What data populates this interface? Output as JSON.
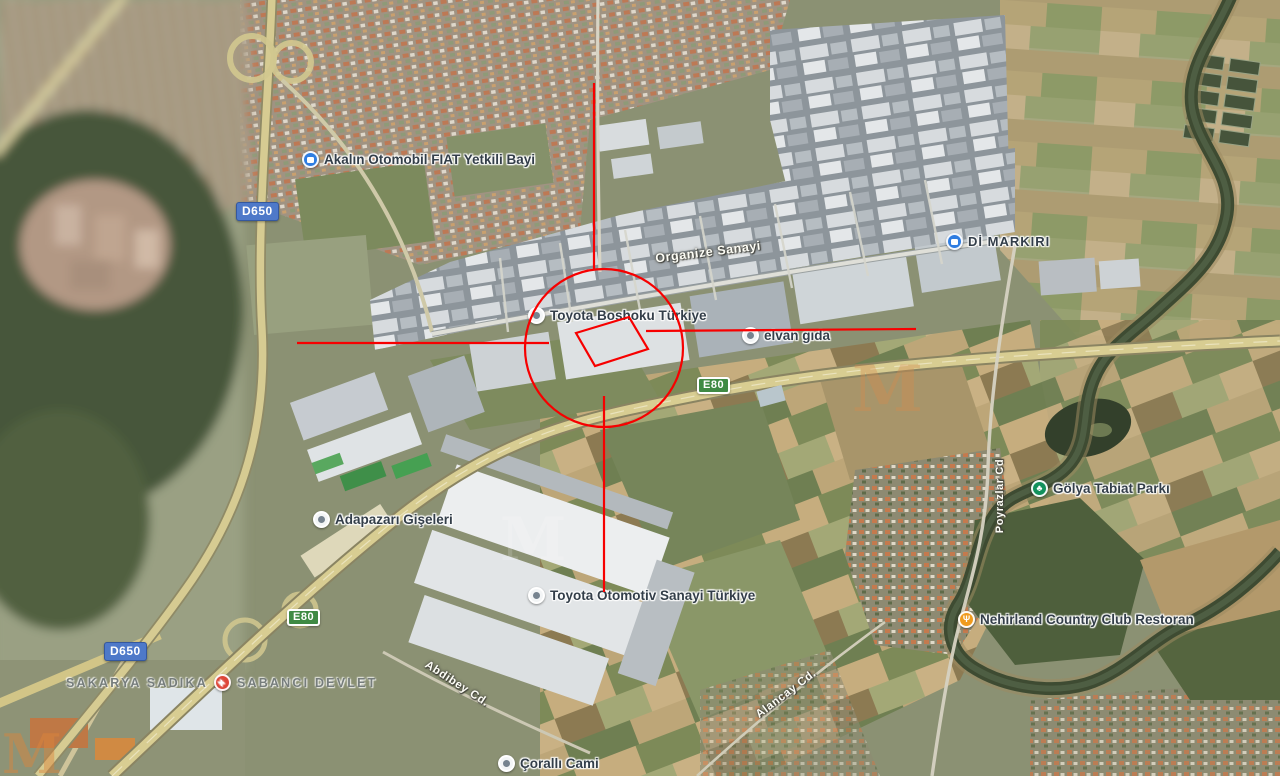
{
  "map": {
    "pois": [
      {
        "id": "fiat-dealer",
        "label": "Akalın Otomobil FIAT Yetkili Bayi",
        "icon": "car-dealer-icon",
        "icon_color": "#2f7de1"
      },
      {
        "id": "market",
        "label": "Dİ MARKIRI",
        "icon": "store-icon",
        "icon_color": "#2f7de1"
      },
      {
        "id": "toyota-boshoku",
        "label": "Toyota Boshoku Türkiye",
        "icon": "factory-poi-icon",
        "icon_color": "#f3f5f6"
      },
      {
        "id": "elvan-gida",
        "label": "elvan gıda",
        "icon": "store-poi-icon",
        "icon_color": "#f3f5f6"
      },
      {
        "id": "golya-park",
        "label": "Gölya Tabiat Parkı",
        "icon": "park-tree-icon",
        "icon_color": "#12915c"
      },
      {
        "id": "adapazari-giseleri",
        "label": "Adapazarı Gişeleri",
        "icon": "toll-poi-icon",
        "icon_color": "#f3f5f6"
      },
      {
        "id": "toyota-otomotiv",
        "label": "Toyota Otomotiv Sanayi Türkiye",
        "icon": "factory-poi-icon",
        "icon_color": "#f3f5f6"
      },
      {
        "id": "nehirland",
        "label": "Nehirland Country Club Restoran",
        "icon": "restaurant-icon",
        "icon_color": "#f09b1d"
      },
      {
        "id": "coralli-cami",
        "label": "Çorallı Cami",
        "icon": "poi-pin-icon",
        "icon_color": "#f3f5f6"
      }
    ],
    "road_badges": [
      {
        "id": "d650-top",
        "label": "D650",
        "color": "#4e79c9"
      },
      {
        "id": "d650-bottom",
        "label": "D650",
        "color": "#4e79c9"
      },
      {
        "id": "e80-mid",
        "label": "E80",
        "color": "#3f8a44"
      },
      {
        "id": "e80-left",
        "label": "E80",
        "color": "#3f8a44"
      }
    ],
    "road_labels": [
      {
        "label": "Organize Sanayi"
      },
      {
        "label": "Abdibey Cd."
      },
      {
        "label": "Alancay Cd."
      },
      {
        "label": "Poyrazlar Cd"
      }
    ],
    "area_label": {
      "prefix": "SAKARYA SADIKA",
      "suffix": "SABANCI DEVLET",
      "icon": "hospital-icon",
      "icon_color": "#dd4638"
    },
    "watermark": {
      "letter": "M"
    }
  },
  "annotation": {
    "color": "#f70000",
    "shapes": "circle, crosshair lines, target parallelogram"
  },
  "icons": {
    "park_glyph": "♣",
    "restaurant_glyph": "Ψ",
    "hospital_glyph": "+"
  }
}
